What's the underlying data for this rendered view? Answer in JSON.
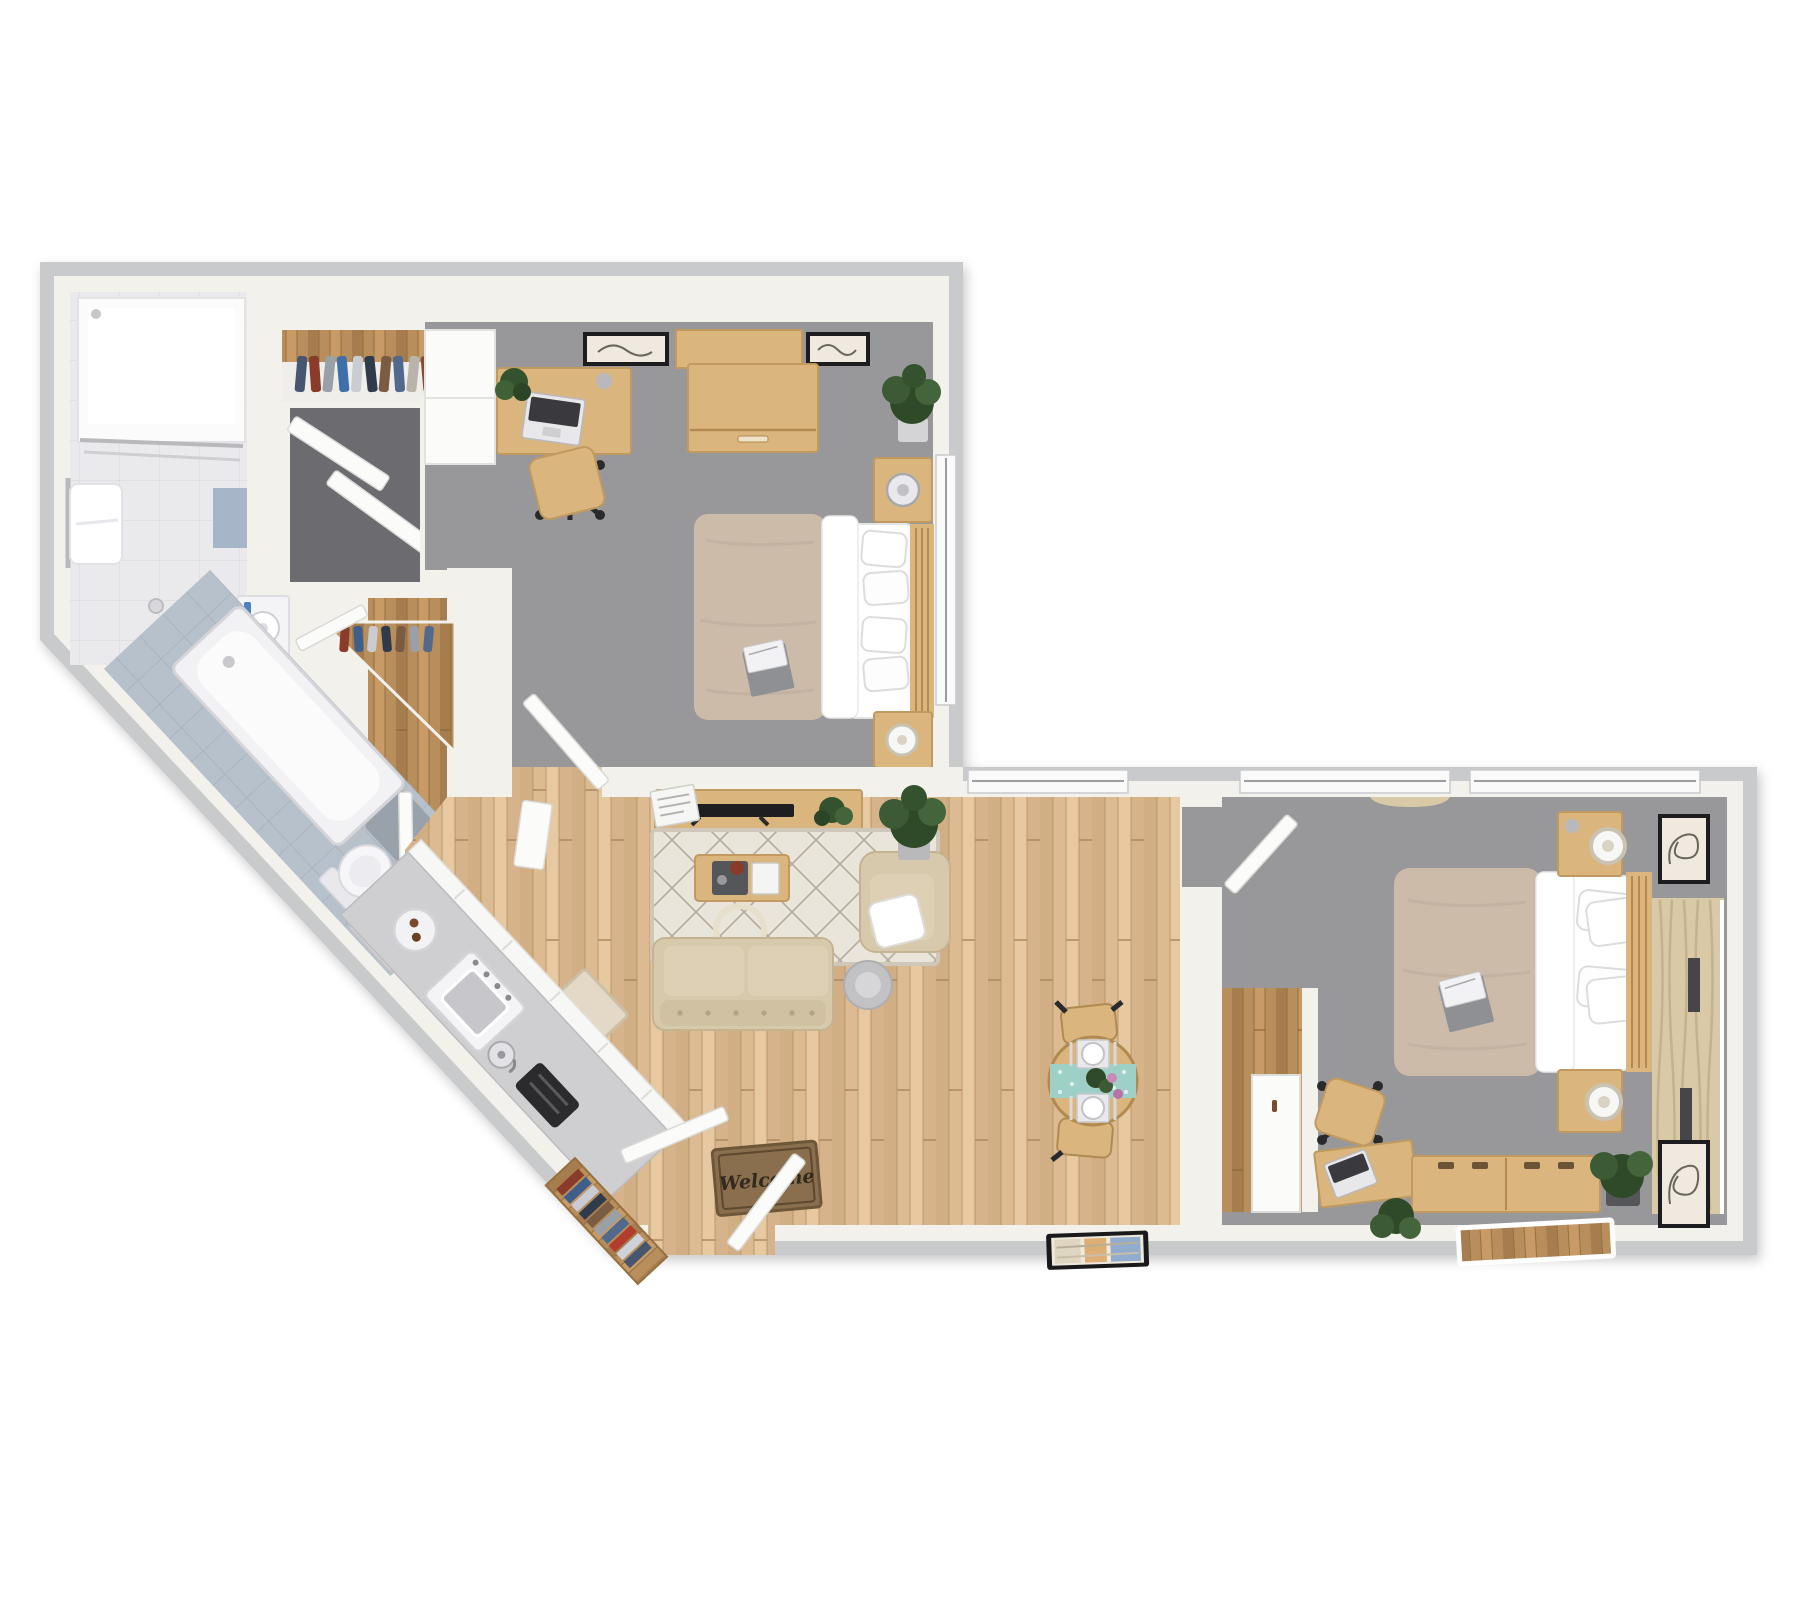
{
  "meta": {
    "type": "3d-floor-plan",
    "description": "Top-down 3D rendering of a two-bedroom, two-bathroom apartment with open living, dining and galley kitchen"
  },
  "entry": {
    "doormat_text": "Welcome"
  },
  "colors": {
    "background": "#ffffff",
    "wall_outer": "#c9cacb",
    "wall_inner": "#f2f1ec",
    "carpet": "#98989b",
    "wood_living": "#dcba92",
    "wood_plank_dark": "#c9a379",
    "wood_plank_light": "#e8cca5",
    "wood_hall": "#b78e5c",
    "oak_furniture": "#dab67e",
    "oak_dark": "#c09a60",
    "tile_bath": "#eaeaec",
    "tile_bath_blue": "#b7c1cb",
    "counter_gray": "#cfcfd1",
    "appliance_white": "#f4f4f6",
    "toaster_black": "#2b2b2e",
    "duvet_beige": "#cdbbaa",
    "linen_white": "#ffffff",
    "sofa_beige": "#d7c9ab",
    "rug_cream": "#eae5da",
    "rug_line": "#a59d8d",
    "doormat_brown": "#8a6f4f",
    "doormat_text_color": "#33291c",
    "runner_teal": "#9fd0c8",
    "curtain_beige": "#d9c9a6",
    "plant_green": "#3c5a34",
    "tv_black": "#1e1e20",
    "closet_dark": "#6b6b70",
    "window_slit": "#46464a"
  },
  "rooms": [
    {
      "name": "Bathroom 1",
      "features": [
        "walk-in shower",
        "toilet",
        "vanity sink",
        "towel bar",
        "blue accent tile"
      ]
    },
    {
      "name": "Bedroom 1",
      "features": [
        "bed with beige duvet",
        "desk with laptop",
        "office chair",
        "white cabinet",
        "dresser",
        "nightstand with fan",
        "nightstand with lamp",
        "wall art",
        "corner plant"
      ]
    },
    {
      "name": "Closets",
      "features": [
        "wardrobe with hanging clothes",
        "dark utility closet with bifold doors",
        "linen closet with wood floor"
      ]
    },
    {
      "name": "Bathroom 2",
      "features": [
        "bathtub",
        "toilet",
        "round vessel sink vanity",
        "bath mat"
      ]
    },
    {
      "name": "Kitchen",
      "features": [
        "galley counter",
        "range",
        "kettle",
        "toaster",
        "serving plate"
      ]
    },
    {
      "name": "Entry",
      "features": [
        "front door",
        "welcome doormat",
        "bookshelf with books"
      ]
    },
    {
      "name": "Living Room",
      "features": [
        "sofa",
        "armchair with pillow",
        "coffee table",
        "media console with TV",
        "arc floor lamp",
        "diamond area rug",
        "round side table",
        "floor plant",
        "small rug"
      ]
    },
    {
      "name": "Dining Nook",
      "features": [
        "round table",
        "teal runner",
        "two place settings",
        "two chairs",
        "flowers"
      ]
    },
    {
      "name": "Bedroom 2",
      "features": [
        "bed with beige duvet",
        "two nightstands with lamps",
        "desk with laptop",
        "office chair",
        "long dresser",
        "sliding-door closet",
        "curtained windows",
        "wall art",
        "plants",
        "leaning mirror"
      ]
    }
  ]
}
